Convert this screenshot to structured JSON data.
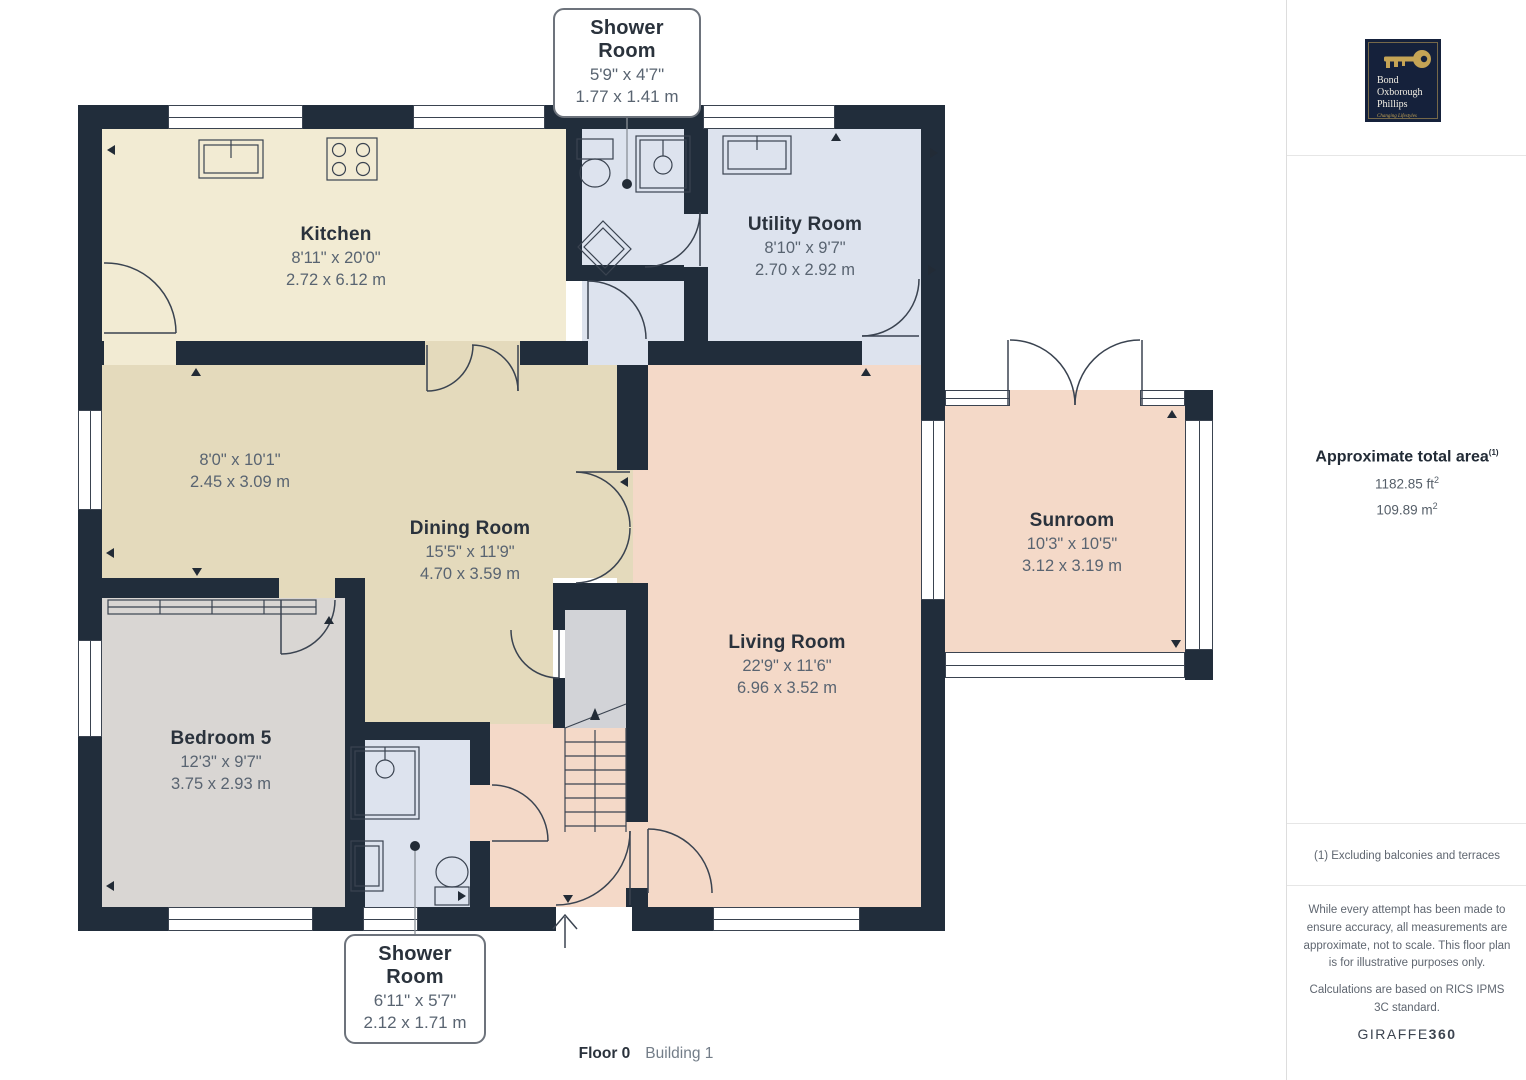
{
  "plan": {
    "floor_label": "Floor 0",
    "building_label": "Building 1",
    "rooms": {
      "kitchen": {
        "name": "Kitchen",
        "dims_imperial": "8'11\" x 20'0\"",
        "dims_metric": "2.72 x 6.12 m"
      },
      "shower_top": {
        "name": "Shower Room",
        "dims_imperial": "5'9\" x 4'7\"",
        "dims_metric": "1.77 x 1.41 m"
      },
      "utility": {
        "name": "Utility Room",
        "dims_imperial": "8'10\" x 9'7\"",
        "dims_metric": "2.70 x 2.92 m"
      },
      "hallway": {
        "dims_imperial": "8'0\" x 10'1\"",
        "dims_metric": "2.45 x 3.09 m"
      },
      "dining": {
        "name": "Dining Room",
        "dims_imperial": "15'5\" x 11'9\"",
        "dims_metric": "4.70 x 3.59 m"
      },
      "bedroom5": {
        "name": "Bedroom 5",
        "dims_imperial": "12'3\" x 9'7\"",
        "dims_metric": "3.75 x 2.93 m"
      },
      "living": {
        "name": "Living Room",
        "dims_imperial": "22'9\" x 11'6\"",
        "dims_metric": "6.96 x 3.52 m"
      },
      "sunroom": {
        "name": "Sunroom",
        "dims_imperial": "10'3\" x 10'5\"",
        "dims_metric": "3.12 x 3.19 m"
      },
      "shower_bottom": {
        "name": "Shower Room",
        "dims_imperial": "6'11\" x 5'7\"",
        "dims_metric": "2.12 x 1.71 m"
      }
    }
  },
  "sidebar": {
    "logo": {
      "line1": "Bond",
      "line2": "Oxborough",
      "line3": "Phillips",
      "tagline": "Changing Lifestyles"
    },
    "area": {
      "title": "Approximate total area",
      "footnote_ref": "(1)",
      "imperial_value": "1182.85 ft",
      "metric_value": "109.89 m",
      "sup": "2"
    },
    "footnote": "(1) Excluding balconies and terraces",
    "disclaimer": "While every attempt has been made to ensure accuracy, all measurements are approximate, not to scale. This floor plan is for illustrative purposes only.",
    "standard": "Calculations are based on RICS IPMS 3C standard.",
    "brand_name": "GIRAFFE",
    "brand_suffix": "360"
  },
  "colors": {
    "wall": "#212d3b",
    "kitchen_floor": "#f2ebd3",
    "wet_room_floor": "#dde3ee",
    "hall_floor": "#e4dabc",
    "bedroom_floor": "#d9d6d3",
    "living_floor": "#f4d9c8",
    "landing_floor": "#d2d3d7",
    "logo_navy": "#15213b",
    "logo_gold": "#c5a455"
  }
}
